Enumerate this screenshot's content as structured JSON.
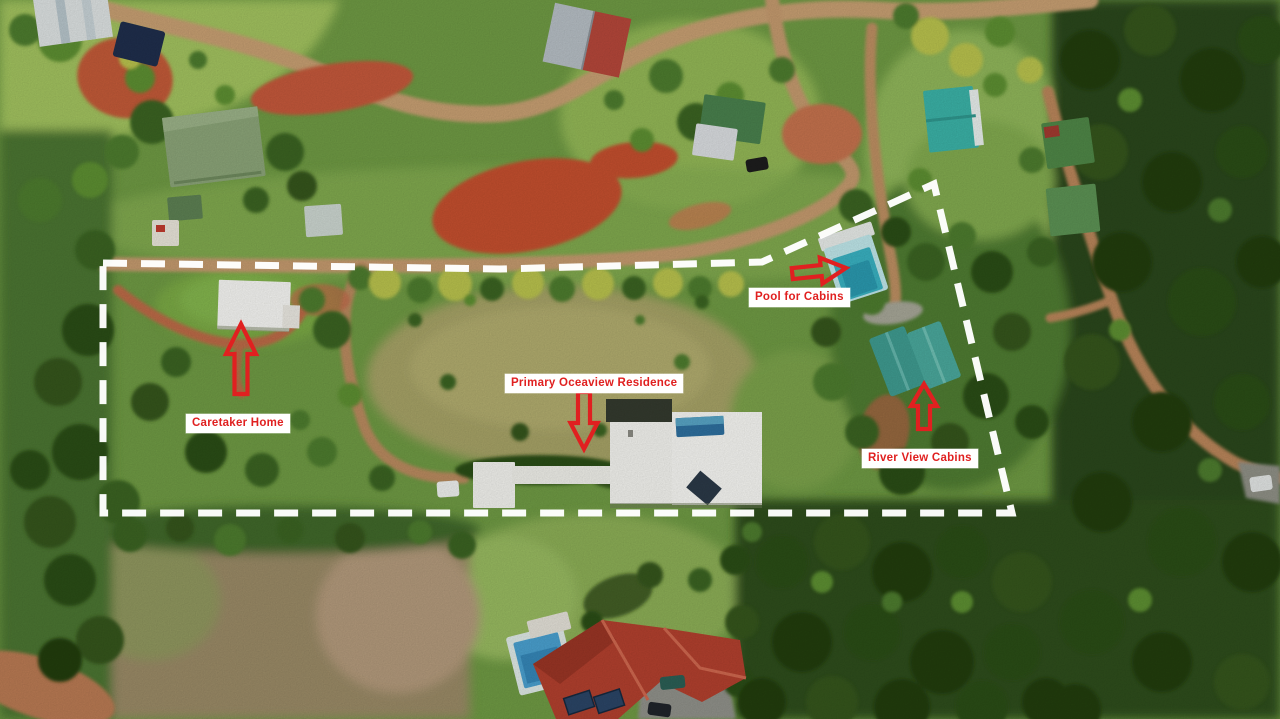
{
  "colors": {
    "annotation_red": "#e02020",
    "boundary_white": "#ffffff",
    "label_bg": "#ffffff"
  },
  "annotations": {
    "labels": [
      {
        "id": "caretaker-home",
        "text": "Caretaker Home",
        "x": 186,
        "y": 414
      },
      {
        "id": "primary-residence",
        "text": "Primary Oceaview Residence",
        "x": 505,
        "y": 374
      },
      {
        "id": "pool-for-cabins",
        "text": "Pool for Cabins",
        "x": 749,
        "y": 288
      },
      {
        "id": "river-view-cabins",
        "text": "River View Cabins",
        "x": 862,
        "y": 449
      }
    ],
    "arrows": [
      {
        "id": "arrow-caretaker-home",
        "points_to": "Caretaker Home",
        "direction": "up",
        "tip": [
          241,
          324
        ],
        "length": 70,
        "head_length": 30,
        "head_width": 30,
        "shaft_width": 13,
        "rotate": 0
      },
      {
        "id": "arrow-primary-residence",
        "points_to": "Primary Oceaview Residence",
        "direction": "down",
        "tip": [
          584,
          449
        ],
        "length": 57,
        "head_length": 26,
        "head_width": 27,
        "shaft_width": 12,
        "rotate": 0
      },
      {
        "id": "arrow-pool-for-cabins",
        "points_to": "Pool for Cabins",
        "direction": "right",
        "tip": [
          846,
          268
        ],
        "length": 54,
        "head_length": 25,
        "head_width": 26,
        "shaft_width": 11,
        "rotate": -6
      },
      {
        "id": "arrow-river-view-cabins",
        "points_to": "River View Cabins",
        "direction": "up",
        "tip": [
          924,
          384
        ],
        "length": 45,
        "head_length": 22,
        "head_width": 26,
        "shaft_width": 12,
        "rotate": 0
      }
    ],
    "boundary": {
      "points": [
        [
          103,
          263
        ],
        [
          500,
          269
        ],
        [
          762,
          262
        ],
        [
          934,
          184
        ],
        [
          1012,
          513
        ],
        [
          103,
          513
        ]
      ],
      "closed": true,
      "dash": [
        24,
        14
      ],
      "stroke_width": 7
    }
  }
}
